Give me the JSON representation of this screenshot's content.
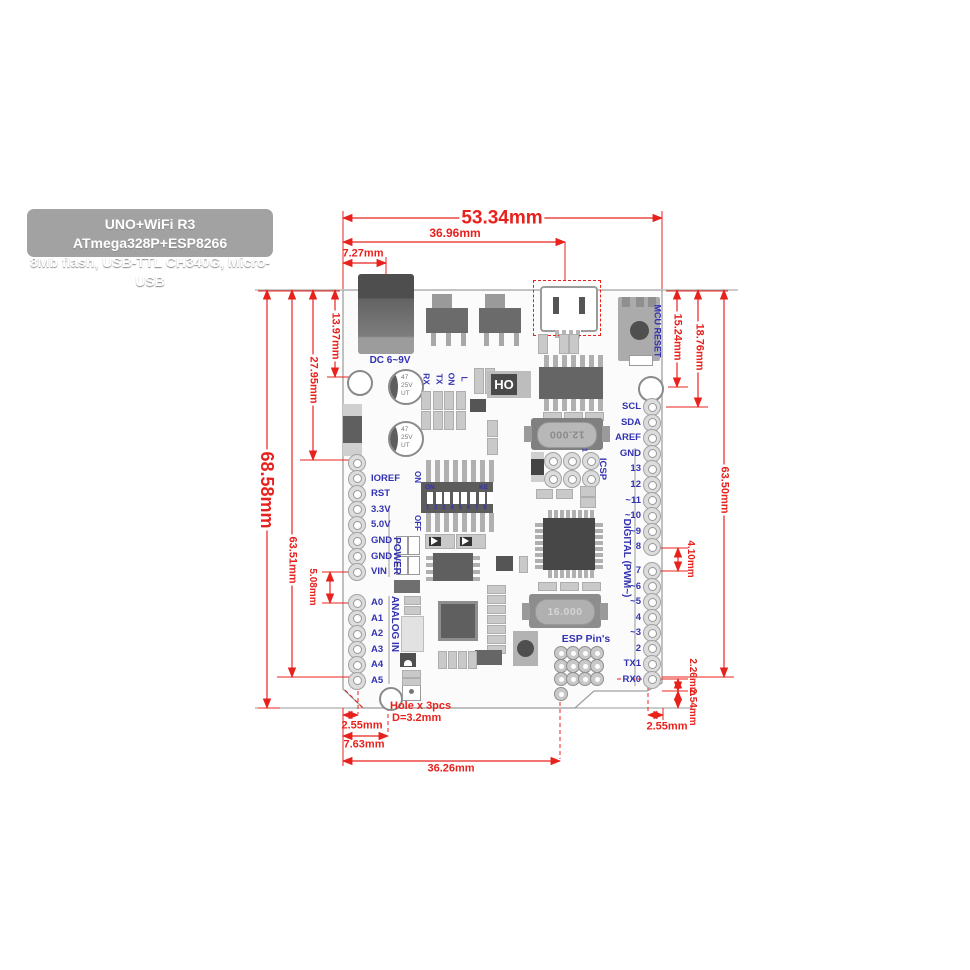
{
  "title": {
    "line1": "UNO+WiFi R3 ATmega328P+ESP8266",
    "line2": "8Mb flash, USB-TTL CH340G, Micro-USB"
  },
  "dims": {
    "top_total": "53.34mm",
    "top_usb": "36.96mm",
    "top_dc": "7.27mm",
    "left_total": "68.58mm",
    "left_63": "63.51mm",
    "left_27": "27.95mm",
    "left_13": "13.97mm",
    "left_5": "5.08mm",
    "right_15": "15.24mm",
    "right_18": "18.76mm",
    "right_63": "63.50mm",
    "right_4": "4.10mm",
    "right_226": "2.26mm",
    "right_254": "2.54mm",
    "right_255": "2.55mm",
    "bottom_255": "2.55mm",
    "bottom_763": "7.63mm",
    "bottom_3626": "36.26mm",
    "hole_note1": "Hole x 3pcs",
    "hole_note2": "D=3.2mm"
  },
  "board": {
    "labels": {
      "dc_power": "DC 6~9V",
      "mcu_reset": "MCU RESET",
      "power": "POWER",
      "analog_in": "ANALOG IN",
      "digital": "DIGITAL (PWM~)",
      "esp_pins": "ESP Pin's",
      "icsp": "ICSP",
      "icsp_pin1": "1",
      "dip_on": "ON",
      "dip_ke": "KE",
      "dip_numbers": "1 2 3 4 5 6 7 8",
      "sw_on": "ON",
      "sw_off": "OFF"
    },
    "leds": [
      "RX",
      "TX",
      "ON",
      "L"
    ],
    "left_pins": [
      "IOREF",
      "RST",
      "3.3V",
      "5.0V",
      "GND",
      "GND",
      "VIN"
    ],
    "analog_pins": [
      "A0",
      "A1",
      "A2",
      "A3",
      "A4",
      "A5"
    ],
    "right_pins_top": [
      "SCL",
      "SDA",
      "AREF",
      "GND",
      "13",
      "12",
      "~11",
      "~10",
      "~9",
      "8"
    ],
    "right_pins_bottom": [
      "7",
      "~6",
      "~5",
      "4",
      "~3",
      "2",
      "TX1",
      "RX0"
    ],
    "components": {
      "cap_value": "47",
      "cap_voltage": "25V",
      "cap_series": "UT",
      "crystal_usb": "12.000",
      "crystal_mcu": "16.000",
      "usb_chip": "HO"
    }
  },
  "colors": {
    "dimension_red": "#e8211d",
    "silkscreen_blue": "#3232b2",
    "board_fill": "#fbfbfb",
    "board_border": "#a0a0a0",
    "component_dark": "#5c5c5c",
    "component_light": "#c9c9c9",
    "title_bg": "#a2a2a2"
  }
}
